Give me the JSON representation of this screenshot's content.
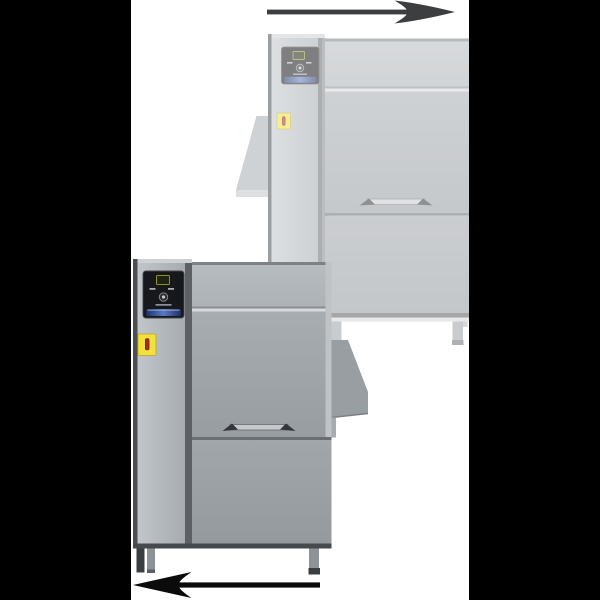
{
  "canvas": {
    "background": "#000000",
    "artwork_background": "#ffffff"
  },
  "arrows": {
    "top": {
      "direction": "right",
      "color": "#3d3e40"
    },
    "bottom": {
      "direction": "left",
      "color": "#0b0b0b"
    }
  },
  "machines": {
    "ghost": {
      "opacity": 0.55,
      "panel_color": "#17181b",
      "panel_accent_blue": "#4a67b0",
      "warning_label_color": "#f2e13c",
      "warning_symbol_color": "#a62b1e"
    },
    "foreground": {
      "opacity": 1,
      "panel_color": "#17181b",
      "panel_accent_blue": "#4a67b0",
      "warning_label_color": "#f2e13c",
      "warning_symbol_color": "#a62b1e"
    }
  },
  "steel_colors": {
    "light": "#c3c7cb",
    "mid": "#9aa0a4",
    "dark": "#53575b"
  }
}
